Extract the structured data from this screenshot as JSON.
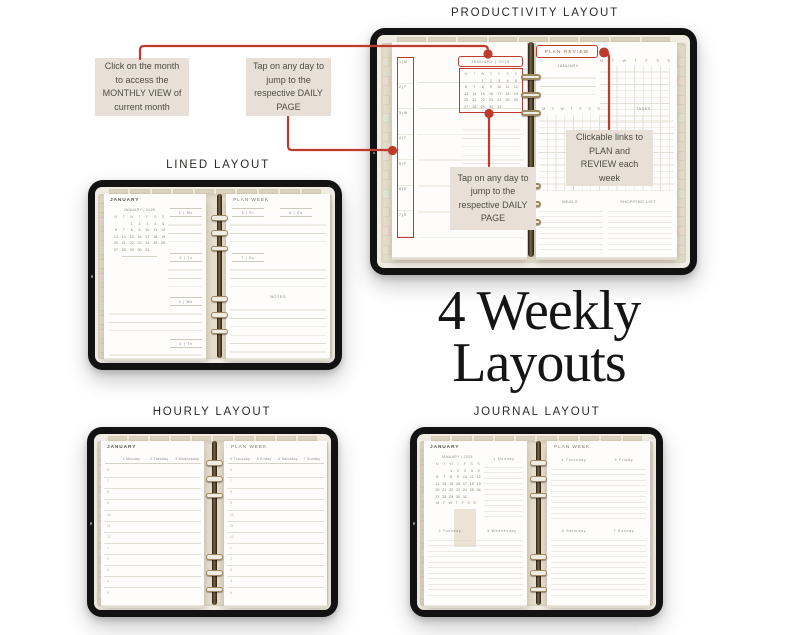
{
  "colors": {
    "accent_red": "#bf3a2b",
    "callout_bg": "#e8e0d6",
    "callout_text": "#4e4b45",
    "bezel_black": "#121212",
    "screen_bg": "#f1ece2",
    "page_bg": "#fefdfb",
    "cover_beige": "#e7dfcd",
    "ring_gold": "#9d8a60",
    "title_color": "#151515"
  },
  "headings": {
    "productivity": "PRODUCTIVITY LAYOUT",
    "lined": "LINED LAYOUT",
    "hourly": "HOURLY LAYOUT",
    "journal": "JOURNAL LAYOUT"
  },
  "main_title": {
    "line1": "4 Weekly",
    "line2": "Layouts"
  },
  "callouts": {
    "monthly_view": "Click on the month to access the MONTHLY VIEW of current month",
    "daily_top": "Tap on any day to jump to the respective DAILY PAGE",
    "daily_inner": "Tap on any day to jump to the respective DAILY PAGE",
    "plan_review": "Clickable links to PLAN and REVIEW each week"
  },
  "planner": {
    "month": "JANUARY",
    "month_header": "JANUARY | 2025",
    "plan_review_tab": "PLAN REVIEW",
    "plan_week_tab": "PLAN WEEK",
    "weekday_letters": [
      "M",
      "T",
      "W",
      "T",
      "F",
      "S",
      "S"
    ],
    "day_column": [
      "1 | M",
      "2 | T",
      "3 | W",
      "4 | T",
      "5 | F",
      "6 | S",
      "7 | S"
    ],
    "day_cells": [
      "1 | Mo",
      "2 | Tu",
      "3 | We",
      "4 | Th",
      "5 | Fr",
      "6 | Sa",
      "7 | Su"
    ],
    "days": [
      "1 Monday",
      "2 Tuesday",
      "3 Wednesday",
      "4 Thursday",
      "5 Friday",
      "6 Saturday",
      "7 Sunday"
    ],
    "hours": [
      "6",
      "7",
      "8",
      "9",
      "10",
      "11",
      "12",
      "1",
      "2",
      "3",
      "4",
      "5"
    ],
    "tasks_label": "TASKS",
    "meals_label": "MEALS",
    "shopping_label": "SHOPPING LIST",
    "notes_label": "NOTES",
    "mini_calendar_rows": [
      [
        "",
        "",
        "1",
        "2",
        "3",
        "4",
        "5"
      ],
      [
        "6",
        "7",
        "8",
        "9",
        "10",
        "11",
        "12"
      ],
      [
        "13",
        "14",
        "15",
        "16",
        "17",
        "18",
        "19"
      ],
      [
        "20",
        "21",
        "22",
        "23",
        "24",
        "25",
        "26"
      ],
      [
        "27",
        "28",
        "29",
        "30",
        "31",
        "",
        ""
      ]
    ]
  }
}
